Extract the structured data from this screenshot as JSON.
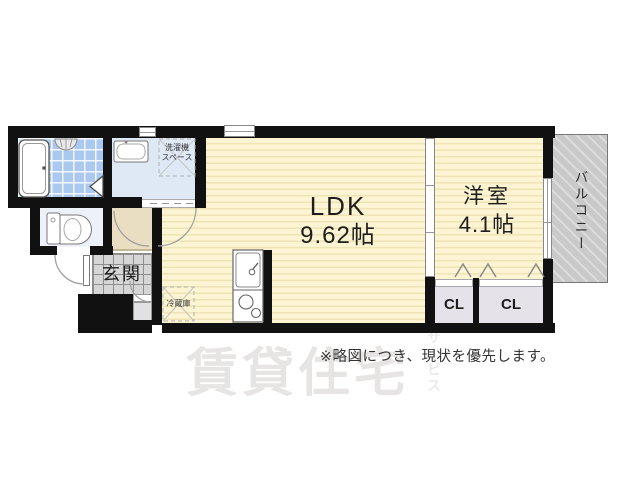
{
  "plan": {
    "ldk": {
      "label": "LDK",
      "size": "9.62帖"
    },
    "western_room": {
      "label": "洋室",
      "size": "4.1帖"
    },
    "entrance": {
      "label": "玄関"
    },
    "balcony": {
      "label": "バルコニー"
    },
    "closet_left": {
      "label": "CL"
    },
    "closet_right": {
      "label": "CL"
    },
    "washer_space": {
      "line1": "洗濯機",
      "line2": "スペース"
    },
    "refrigerator": {
      "label": "冷蔵庫"
    }
  },
  "footer": {
    "disclaimer": "※略図につき、現状を優先します。"
  },
  "watermark": {
    "main": "賃貸住宅",
    "sub": "サービス"
  },
  "colors": {
    "wall": "#111111",
    "ldk_floor": "#fcf4d2",
    "ldk_stripe": "#efe4b6",
    "bath_tile": "#abc9f0",
    "washroom_floor": "#dfe9f6",
    "toilet_floor": "#edf2fa",
    "hallway_floor": "#e9dec1",
    "entrance_tile": "#d6d6d6",
    "closet_floor": "#e5e2ea",
    "balcony": "#c9c9c9"
  }
}
